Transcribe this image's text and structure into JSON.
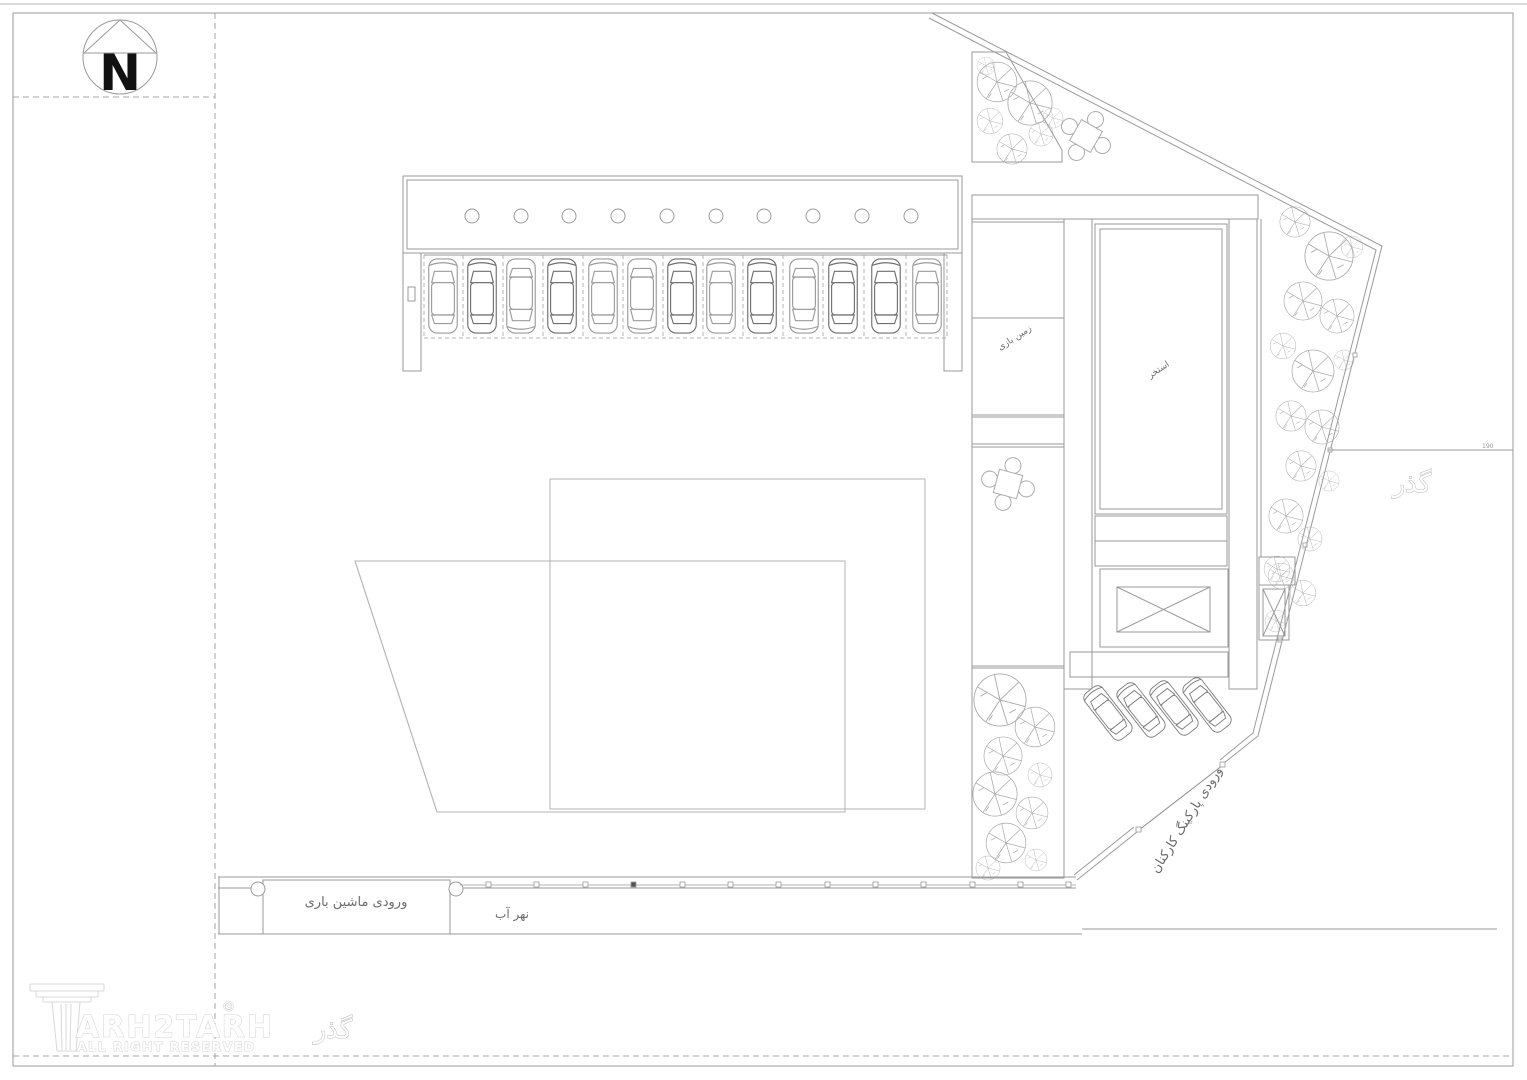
{
  "compass": {
    "north_label": "N"
  },
  "plan_labels": {
    "cargo_entrance": "ورودی ماشین باری",
    "water_channel": "نهر آب",
    "staff_parking_entrance": "ورودی پارکینگ کارکنان",
    "passage_right": "گذر",
    "passage_bottom": "گذر",
    "pool": "استخر",
    "playground_room": "زمین بازی",
    "edge_dimension": "190"
  },
  "logo": {
    "brand_text": "ARH2TARH",
    "copyright": "©",
    "tagline": "ALL RIGHT RESERVED"
  },
  "colors": {
    "linework": "#9a9a9a",
    "dark_linework": "#6f6f6f",
    "hatch": "#c2c2c2",
    "label_text": "#6b6b6b",
    "logo_outline": "#d2d2d2",
    "north_arrow": "#111111"
  }
}
